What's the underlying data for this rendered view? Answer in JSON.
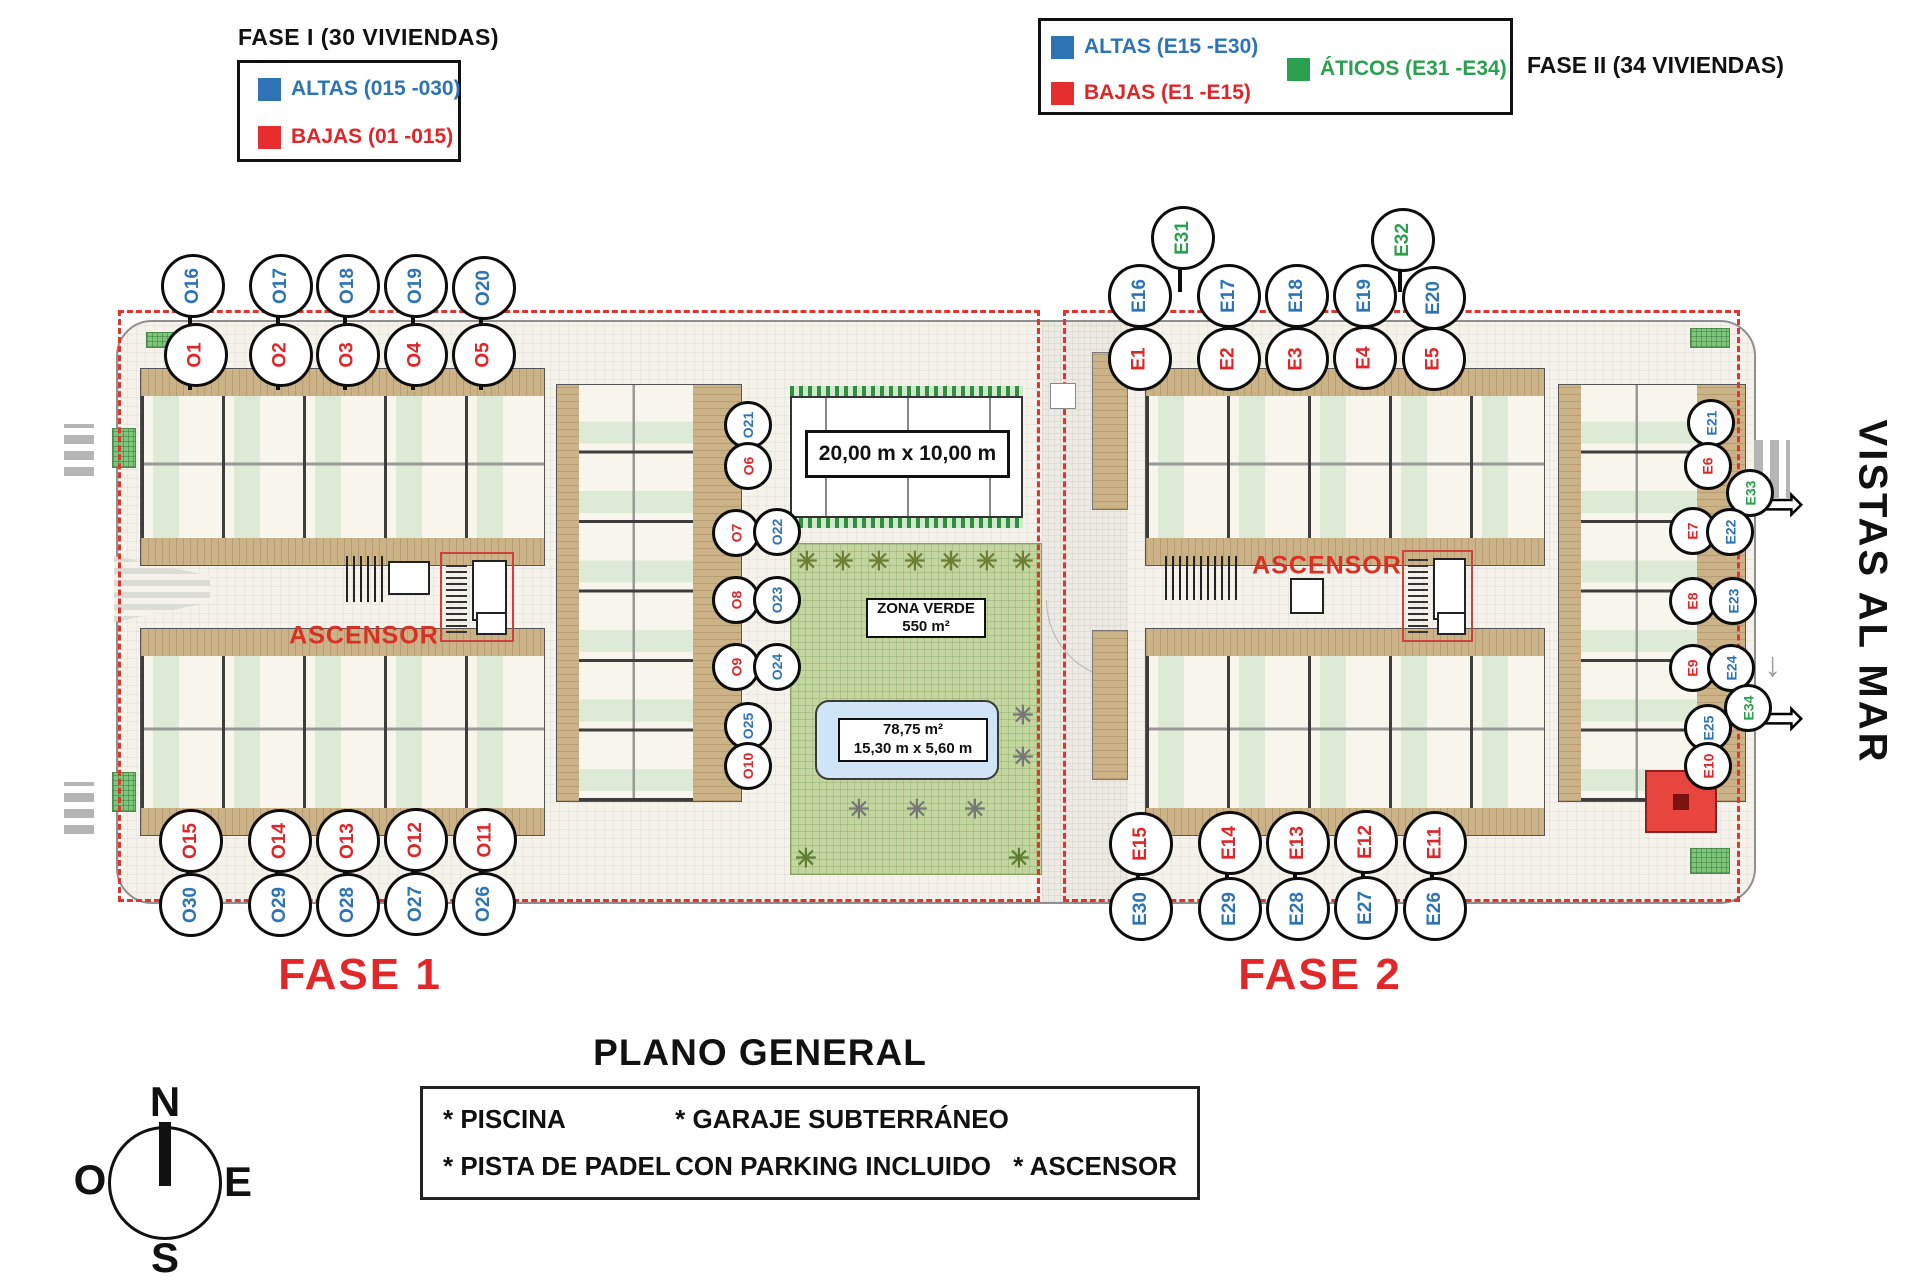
{
  "colors": {
    "blue": "#2e74b5",
    "red": "#e02528",
    "green": "#2aa14e",
    "dashed": "#df352e",
    "ascensor_red": "#d93025",
    "fase_red": "#e0282b"
  },
  "legend_fase1": {
    "title": "FASE I (30 VIVIENDAS)",
    "items": [
      {
        "label": "ALTAS (015 -030)",
        "color": "#2e74b5"
      },
      {
        "label": "BAJAS (01 -015)",
        "color": "#e62e2e"
      }
    ]
  },
  "legend_fase2": {
    "side_label": "FASE II (34 VIVIENDAS)",
    "items": [
      {
        "label": "ALTAS (E15 -E30)",
        "color": "#2e74b5"
      },
      {
        "label": "BAJAS (E1 -E15)",
        "color": "#e62e2e"
      },
      {
        "label": "ÁTICOS (E31 -E34)",
        "color": "#2aa14e"
      }
    ]
  },
  "plan": {
    "fase1_label": "FASE 1",
    "fase2_label": "FASE 2",
    "ascensor1": "ASCENSOR",
    "ascensor2": "ASCENSOR",
    "vistas_al_mar": "VISTAS AL MAR",
    "padel_dimensions": "20,00 m x 10,00 m",
    "zona_verde_line1": "ZONA VERDE",
    "zona_verde_line2": "550 m²",
    "pool_line1": "78,75 m²",
    "pool_line2": "15,30 m x 5,60 m",
    "arrow_icon": "⇨",
    "down_arrow_icon": "↓",
    "tree_icon": "✳",
    "umbrella_icon": "✳"
  },
  "title": "PLANO GENERAL",
  "amenities": {
    "items": [
      [
        "* PISCINA",
        "* GARAJE SUBTERRÁNEO",
        ""
      ],
      [
        "* PISTA DE PADEL",
        "CON PARKING INCLUIDO",
        "* ASCENSOR"
      ]
    ]
  },
  "compass": {
    "n": "N",
    "s": "S",
    "e": "E",
    "w": "O"
  },
  "circles": [
    {
      "id": "O16",
      "x": 190,
      "y": 283,
      "color": "blue",
      "size": "lg"
    },
    {
      "id": "O17",
      "x": 278,
      "y": 283,
      "color": "blue",
      "size": "lg"
    },
    {
      "id": "O18",
      "x": 345,
      "y": 283,
      "color": "blue",
      "size": "lg"
    },
    {
      "id": "O19",
      "x": 413,
      "y": 283,
      "color": "blue",
      "size": "lg"
    },
    {
      "id": "O20",
      "x": 481,
      "y": 285,
      "color": "blue",
      "size": "lg"
    },
    {
      "id": "O1",
      "x": 193,
      "y": 352,
      "color": "red",
      "size": "lg"
    },
    {
      "id": "O2",
      "x": 278,
      "y": 352,
      "color": "red",
      "size": "lg"
    },
    {
      "id": "O3",
      "x": 345,
      "y": 352,
      "color": "red",
      "size": "lg"
    },
    {
      "id": "O4",
      "x": 413,
      "y": 352,
      "color": "red",
      "size": "lg"
    },
    {
      "id": "O5",
      "x": 481,
      "y": 352,
      "color": "red",
      "size": "lg"
    },
    {
      "id": "O15",
      "x": 188,
      "y": 838,
      "color": "red",
      "size": "lg"
    },
    {
      "id": "O14",
      "x": 277,
      "y": 838,
      "color": "red",
      "size": "lg"
    },
    {
      "id": "O13",
      "x": 345,
      "y": 838,
      "color": "red",
      "size": "lg"
    },
    {
      "id": "O12",
      "x": 413,
      "y": 837,
      "color": "red",
      "size": "lg"
    },
    {
      "id": "O11",
      "x": 482,
      "y": 837,
      "color": "red",
      "size": "lg"
    },
    {
      "id": "O30",
      "x": 188,
      "y": 902,
      "color": "blue",
      "size": "lg"
    },
    {
      "id": "O29",
      "x": 277,
      "y": 902,
      "color": "blue",
      "size": "lg"
    },
    {
      "id": "O28",
      "x": 345,
      "y": 902,
      "color": "blue",
      "size": "lg"
    },
    {
      "id": "O27",
      "x": 413,
      "y": 901,
      "color": "blue",
      "size": "lg"
    },
    {
      "id": "O26",
      "x": 481,
      "y": 901,
      "color": "blue",
      "size": "lg"
    },
    {
      "id": "O21",
      "x": 745,
      "y": 422,
      "color": "blue",
      "size": "sm"
    },
    {
      "id": "O6",
      "x": 745,
      "y": 463,
      "color": "red",
      "size": "sm"
    },
    {
      "id": "O7",
      "x": 733,
      "y": 530,
      "color": "red",
      "size": "sm"
    },
    {
      "id": "O22",
      "x": 774,
      "y": 529,
      "color": "blue",
      "size": "sm"
    },
    {
      "id": "O8",
      "x": 733,
      "y": 597,
      "color": "red",
      "size": "sm"
    },
    {
      "id": "O23",
      "x": 774,
      "y": 597,
      "color": "blue",
      "size": "sm"
    },
    {
      "id": "O9",
      "x": 733,
      "y": 664,
      "color": "red",
      "size": "sm"
    },
    {
      "id": "O24",
      "x": 774,
      "y": 664,
      "color": "blue",
      "size": "sm"
    },
    {
      "id": "O25",
      "x": 745,
      "y": 723,
      "color": "blue",
      "size": "sm"
    },
    {
      "id": "O10",
      "x": 745,
      "y": 763,
      "color": "red",
      "size": "sm"
    },
    {
      "id": "E31",
      "x": 1180,
      "y": 235,
      "color": "green",
      "size": "lg"
    },
    {
      "id": "E32",
      "x": 1400,
      "y": 237,
      "color": "green",
      "size": "lg"
    },
    {
      "id": "E16",
      "x": 1137,
      "y": 293,
      "color": "blue",
      "size": "lg"
    },
    {
      "id": "E17",
      "x": 1226,
      "y": 293,
      "color": "blue",
      "size": "lg"
    },
    {
      "id": "E18",
      "x": 1294,
      "y": 293,
      "color": "blue",
      "size": "lg"
    },
    {
      "id": "E19",
      "x": 1362,
      "y": 293,
      "color": "blue",
      "size": "lg"
    },
    {
      "id": "E20",
      "x": 1431,
      "y": 295,
      "color": "blue",
      "size": "lg"
    },
    {
      "id": "E1",
      "x": 1137,
      "y": 356,
      "color": "red",
      "size": "lg"
    },
    {
      "id": "E2",
      "x": 1226,
      "y": 356,
      "color": "red",
      "size": "lg"
    },
    {
      "id": "E3",
      "x": 1294,
      "y": 356,
      "color": "red",
      "size": "lg"
    },
    {
      "id": "E4",
      "x": 1362,
      "y": 355,
      "color": "red",
      "size": "lg"
    },
    {
      "id": "E5",
      "x": 1431,
      "y": 356,
      "color": "red",
      "size": "lg"
    },
    {
      "id": "E15",
      "x": 1138,
      "y": 841,
      "color": "red",
      "size": "lg"
    },
    {
      "id": "E14",
      "x": 1227,
      "y": 840,
      "color": "red",
      "size": "lg"
    },
    {
      "id": "E13",
      "x": 1295,
      "y": 840,
      "color": "red",
      "size": "lg"
    },
    {
      "id": "E12",
      "x": 1363,
      "y": 839,
      "color": "red",
      "size": "lg"
    },
    {
      "id": "E11",
      "x": 1432,
      "y": 840,
      "color": "red",
      "size": "lg"
    },
    {
      "id": "E30",
      "x": 1138,
      "y": 906,
      "color": "blue",
      "size": "lg"
    },
    {
      "id": "E29",
      "x": 1227,
      "y": 906,
      "color": "blue",
      "size": "lg"
    },
    {
      "id": "E28",
      "x": 1295,
      "y": 906,
      "color": "blue",
      "size": "lg"
    },
    {
      "id": "E27",
      "x": 1363,
      "y": 905,
      "color": "blue",
      "size": "lg"
    },
    {
      "id": "E26",
      "x": 1432,
      "y": 906,
      "color": "blue",
      "size": "lg"
    },
    {
      "id": "E21",
      "x": 1708,
      "y": 420,
      "color": "blue",
      "size": "sm"
    },
    {
      "id": "E6",
      "x": 1705,
      "y": 463,
      "color": "red",
      "size": "sm"
    },
    {
      "id": "E33",
      "x": 1747,
      "y": 490,
      "color": "green",
      "size": "sm"
    },
    {
      "id": "E7",
      "x": 1690,
      "y": 528,
      "color": "red",
      "size": "sm"
    },
    {
      "id": "E22",
      "x": 1727,
      "y": 529,
      "color": "blue",
      "size": "sm"
    },
    {
      "id": "E8",
      "x": 1690,
      "y": 598,
      "color": "red",
      "size": "sm"
    },
    {
      "id": "E23",
      "x": 1730,
      "y": 598,
      "color": "blue",
      "size": "sm"
    },
    {
      "id": "E9",
      "x": 1690,
      "y": 665,
      "color": "red",
      "size": "sm"
    },
    {
      "id": "E24",
      "x": 1728,
      "y": 665,
      "color": "blue",
      "size": "sm"
    },
    {
      "id": "E34",
      "x": 1745,
      "y": 705,
      "color": "green",
      "size": "sm"
    },
    {
      "id": "E25",
      "x": 1705,
      "y": 725,
      "color": "blue",
      "size": "sm"
    },
    {
      "id": "E10",
      "x": 1705,
      "y": 763,
      "color": "red",
      "size": "sm"
    }
  ],
  "stems": [
    {
      "x": 190,
      "y1": 283,
      "y2": 390
    },
    {
      "x": 278,
      "y1": 283,
      "y2": 390
    },
    {
      "x": 345,
      "y1": 283,
      "y2": 390
    },
    {
      "x": 413,
      "y1": 283,
      "y2": 390
    },
    {
      "x": 481,
      "y1": 285,
      "y2": 390
    },
    {
      "x": 188,
      "y1": 820,
      "y2": 902
    },
    {
      "x": 277,
      "y1": 820,
      "y2": 902
    },
    {
      "x": 345,
      "y1": 820,
      "y2": 902
    },
    {
      "x": 413,
      "y1": 820,
      "y2": 901
    },
    {
      "x": 481,
      "y1": 820,
      "y2": 901
    },
    {
      "x": 1137,
      "y1": 293,
      "y2": 390
    },
    {
      "x": 1226,
      "y1": 293,
      "y2": 390
    },
    {
      "x": 1294,
      "y1": 293,
      "y2": 390
    },
    {
      "x": 1362,
      "y1": 293,
      "y2": 390
    },
    {
      "x": 1431,
      "y1": 295,
      "y2": 390
    },
    {
      "x": 1180,
      "y1": 235,
      "y2": 292
    },
    {
      "x": 1400,
      "y1": 237,
      "y2": 292
    },
    {
      "x": 1138,
      "y1": 822,
      "y2": 906
    },
    {
      "x": 1227,
      "y1": 822,
      "y2": 906
    },
    {
      "x": 1295,
      "y1": 822,
      "y2": 906
    },
    {
      "x": 1363,
      "y1": 822,
      "y2": 905
    },
    {
      "x": 1432,
      "y1": 822,
      "y2": 906
    }
  ]
}
